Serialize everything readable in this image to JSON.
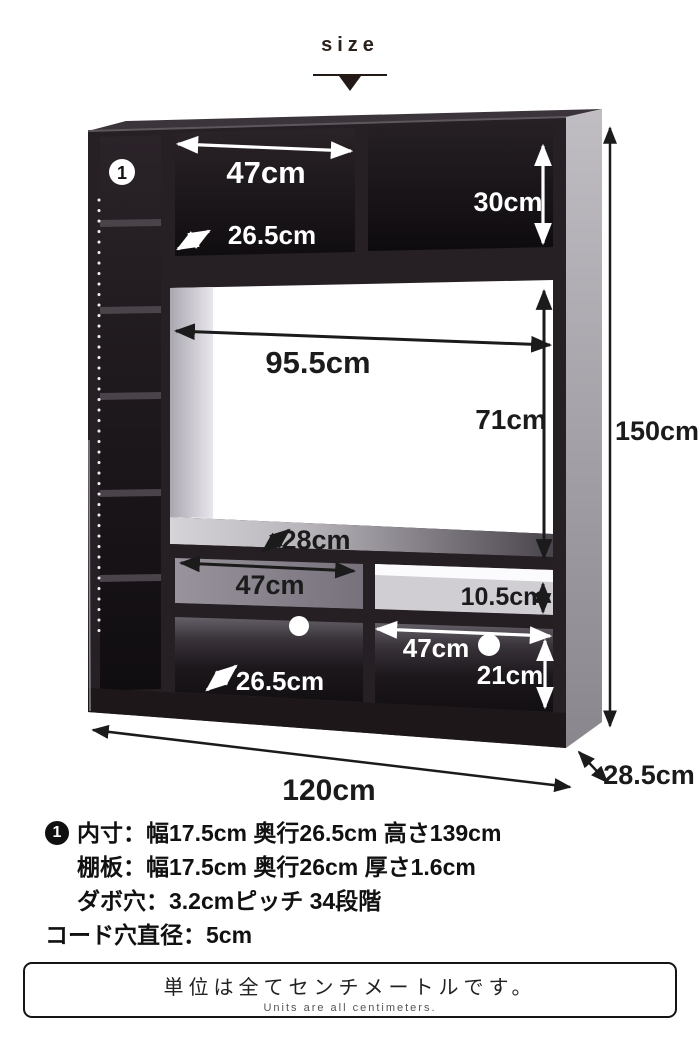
{
  "header": {
    "title": "size",
    "pointer_icon": "down-triangle"
  },
  "diagram": {
    "marker1": "1",
    "dims": {
      "top_shelf_width": "47cm",
      "top_shelf_depth": "26.5cm",
      "top_right_height": "30cm",
      "tv_space_width": "95.5cm",
      "tv_space_height": "71cm",
      "middle_shelf_depth": "28cm",
      "middle_shelf_width": "47cm",
      "middle_row_height": "10.5cm",
      "bottom_right_width": "47cm",
      "bottom_right_height": "21cm",
      "bottom_depth": "26.5cm",
      "overall_width": "120cm",
      "overall_depth": "28.5cm",
      "overall_height": "150cm"
    }
  },
  "notes": {
    "bullet1": "1",
    "line1": "内寸：幅17.5cm 奥行26.5cm 高さ139cm",
    "line2": "棚板：幅17.5cm 奥行26cm 厚さ1.6cm",
    "line3": "ダボ穴：3.2cmピッチ 34段階",
    "line4": "コード穴直径：5cm"
  },
  "footer": {
    "jp": "単位は全てセンチメートルです。",
    "en": "Units are all centimeters."
  },
  "colors": {
    "cabinet_dark": "#241d21",
    "side_gray": "#a8a4ab",
    "dim_black": "#1b1b1b",
    "dim_white": "#ffffff"
  }
}
